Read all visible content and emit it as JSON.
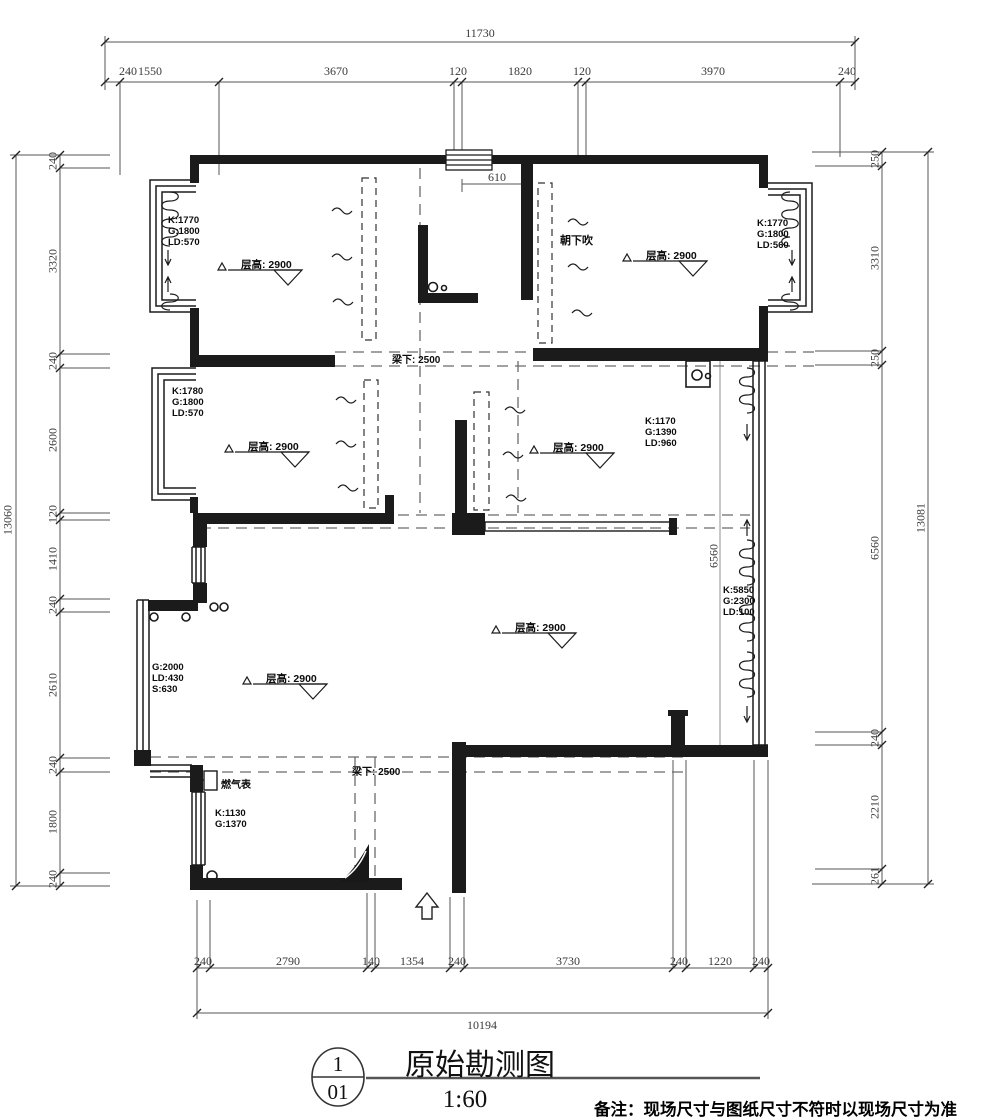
{
  "title_block": {
    "sheet_top": "1",
    "sheet_bottom": "01",
    "title": "原始勘测图",
    "scale": "1:60",
    "note": "备注：现场尺寸与图纸尺寸不符时以现场尺寸为准"
  },
  "dims": {
    "top": {
      "total": "11730",
      "segments": [
        "240",
        "1550",
        "3670",
        "120",
        "1820",
        "120",
        "3970",
        "240"
      ]
    },
    "bottom": {
      "total": "10194",
      "segments": [
        "240",
        "2790",
        "140",
        "1354",
        "240",
        "3730",
        "240",
        "1220",
        "240"
      ]
    },
    "left": {
      "total": "13060",
      "segments": [
        "240",
        "3320",
        "240",
        "2600",
        "120",
        "1410",
        "240",
        "2610",
        "240",
        "1800",
        "240"
      ]
    },
    "right": {
      "total": "13081",
      "segments": [
        "250",
        "3310",
        "250",
        "6560",
        "240",
        "2210",
        "261"
      ]
    },
    "interior": {
      "door_dim": "610",
      "depth_dim": "6560"
    }
  },
  "window_labels": [
    "K:1770\nG:1800\nLD:570",
    "K:1770\nG:1800\nLD:560",
    "K:1780\nG:1800\nLD:570",
    "K:1170\nG:1390\nLD:960",
    "K:5850\nG:2300\nLD:100",
    "G:2000\nLD:430\nS:630",
    "K:1130\nG:1370"
  ],
  "room_heights": [
    "层高: 2900",
    "层高: 2900",
    "层高: 2900",
    "层高: 2900",
    "层高: 2900",
    "层高: 2900"
  ],
  "beam_labels": [
    "梁下: 2500",
    "梁下: 2500"
  ],
  "misc": {
    "gas_meter": "燃气表",
    "vent_note": "朝下吹"
  }
}
